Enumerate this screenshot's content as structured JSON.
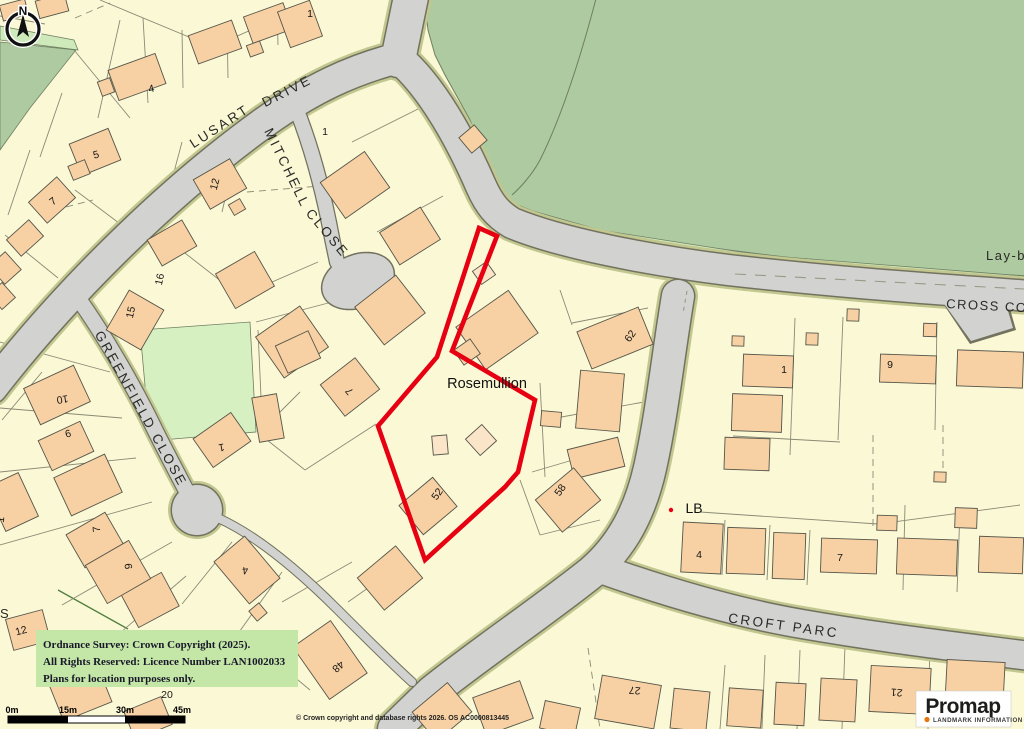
{
  "colors": {
    "parcel_cream": "#fbf8d6",
    "woodland": "#adcaa1",
    "verge_light_green": "#cfeaba",
    "field_green": "#d7f0c2",
    "road_gray": "#d2d2d0",
    "road_verge_olive": "#c2c790",
    "building_fill": "#f7d1a3",
    "site_boundary": "#e60012",
    "copyright_bg": "#c4e6a6",
    "promap_orange": "#e87511"
  },
  "north_arrow": {
    "label": "N"
  },
  "streets": {
    "lusart_drive_1": "LUSART",
    "lusart_drive_2": "DRIVE",
    "mitchell_1": "MITCHELL",
    "mitchell_2": "CLOSE",
    "greenfield_close": "GREENFIELD CLOSE",
    "cross_common": "CROSS CO",
    "croft_parc": "CROFT PARC",
    "lay_by": "Lay-b",
    "partial_s": "S"
  },
  "labels": {
    "plot_name": "Rosemullion",
    "letter_box": "LB"
  },
  "house_numbers": [
    "4",
    "5",
    "7",
    "1",
    "12",
    "1",
    "16",
    "15",
    "10",
    "6",
    "1",
    "7",
    "9",
    "12",
    "1",
    "7",
    "52",
    "58",
    "62",
    "48",
    "20",
    "4",
    "27",
    "21",
    "4",
    "7",
    "9",
    "1"
  ],
  "copyright_box": {
    "line1": "Ordnance Survey: Crown Copyright (2025).",
    "line2": "All Rights Reserved: Licence Number LAN1002033",
    "line3": "Plans for location purposes only."
  },
  "scale_bar": {
    "labels": [
      "0m",
      "15m",
      "30m",
      "45m"
    ]
  },
  "attribution": "© Crown copyright and database rights 2026. OS AC0000813445",
  "logo": {
    "name": "Promap",
    "tagline": "LANDMARK INFORMATION"
  }
}
